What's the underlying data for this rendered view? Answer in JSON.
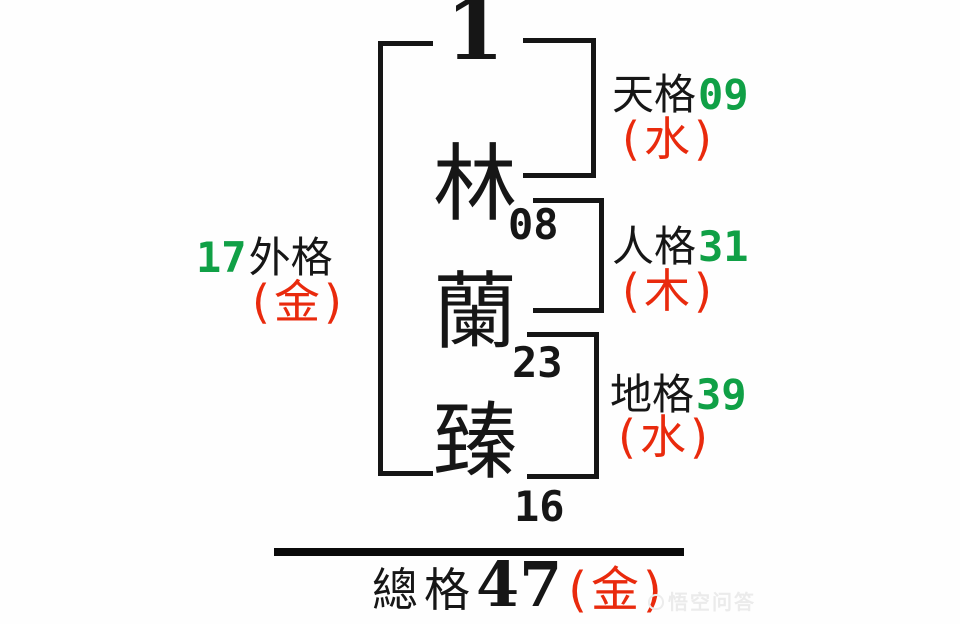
{
  "name_diagram": {
    "top_number": "1",
    "characters": [
      {
        "char": "林",
        "strokes": "08"
      },
      {
        "char": "蘭",
        "strokes": "23"
      },
      {
        "char": "臻",
        "strokes": "16"
      }
    ],
    "right_grids": [
      {
        "label": "天格",
        "value": "09",
        "element": "(水)"
      },
      {
        "label": "人格",
        "value": "31",
        "element": "(木)"
      },
      {
        "label": "地格",
        "value": "39",
        "element": "(水)"
      }
    ],
    "outer_grid": {
      "value": "17",
      "label": "外格",
      "element": "(金)"
    },
    "total_grid": {
      "label": "總格",
      "value": "47",
      "element": "(金)"
    },
    "watermark": "悟空问答"
  },
  "colors": {
    "ink_black": "#161616",
    "number_green": "#10A046",
    "element_red": "#E92A0D"
  }
}
